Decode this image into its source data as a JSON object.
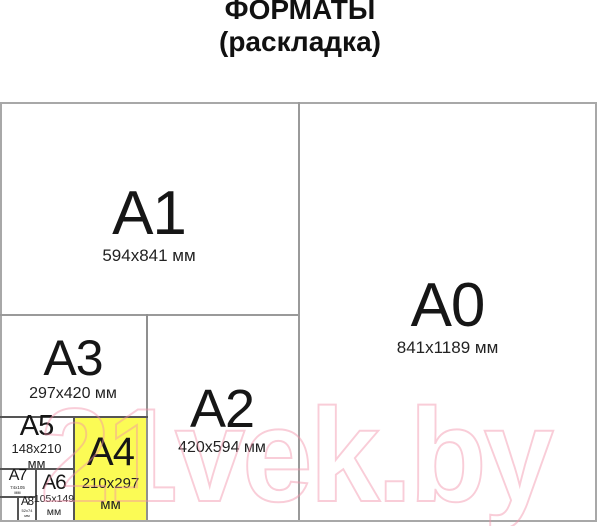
{
  "title": {
    "line1": "ФОРМАТЫ",
    "line2": "(раскладка)"
  },
  "watermark": {
    "text": "21vek.by"
  },
  "colors": {
    "a4_highlight": "#FBFB55",
    "watermark_pink": "#F290A9",
    "outer_border_gray": "#A8A8A8",
    "major_divider_gray": "#9A9A9A",
    "minor_divider_dark": "#555555"
  },
  "formats": {
    "a0": {
      "name": "A0",
      "dims": "841x1189 мм"
    },
    "a1": {
      "name": "A1",
      "dims": "594x841 мм"
    },
    "a2": {
      "name": "A2",
      "dims": "420x594 мм"
    },
    "a3": {
      "name": "A3",
      "dims": "297x420 мм"
    },
    "a4": {
      "name": "A4",
      "size": "210x297",
      "unit": "мм"
    },
    "a5": {
      "name": "A5",
      "size": "148x210",
      "unit": "мм"
    },
    "a6": {
      "name": "A6",
      "size": "105x149",
      "unit": "мм"
    },
    "a7": {
      "name": "A7",
      "size": "74x105",
      "unit": "мм"
    },
    "a8": {
      "name": "A8",
      "size": "52x74",
      "unit": "мм"
    }
  }
}
